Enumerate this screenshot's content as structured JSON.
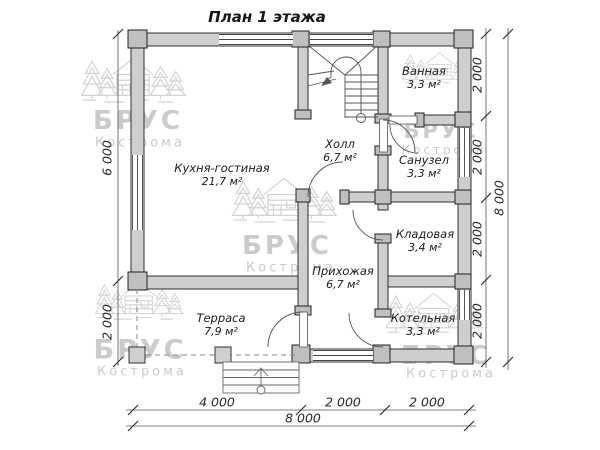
{
  "title": "План 1 этажа",
  "rooms": [
    {
      "name": "Кухня-гостиная",
      "area": "21,7 м²"
    },
    {
      "name": "Холл",
      "area": "6,7 м²"
    },
    {
      "name": "Ванная",
      "area": "3,3 м²"
    },
    {
      "name": "Санузел",
      "area": "3,3 м²"
    },
    {
      "name": "Кладовая",
      "area": "3,4 м²"
    },
    {
      "name": "Прихожая",
      "area": "6,7 м²"
    },
    {
      "name": "Котельная",
      "area": "3,3 м²"
    },
    {
      "name": "Терраса",
      "area": "7,9 м²"
    }
  ],
  "dimensions": {
    "left": [
      "6 000",
      "2 000"
    ],
    "right": [
      "2 000",
      "2 000",
      "2 000",
      "2 000"
    ],
    "right_total": "8 000",
    "bottom": [
      "4 000",
      "2 000",
      "2 000"
    ],
    "bottom_total": "8 000"
  },
  "watermark": {
    "brand": "БРУС",
    "city": "Кострома"
  },
  "colors": {
    "wall_fill": "#cecece",
    "wall_edge": "#2f2f2f",
    "thin_line": "#555555",
    "watermark": "#c2c2c2"
  }
}
